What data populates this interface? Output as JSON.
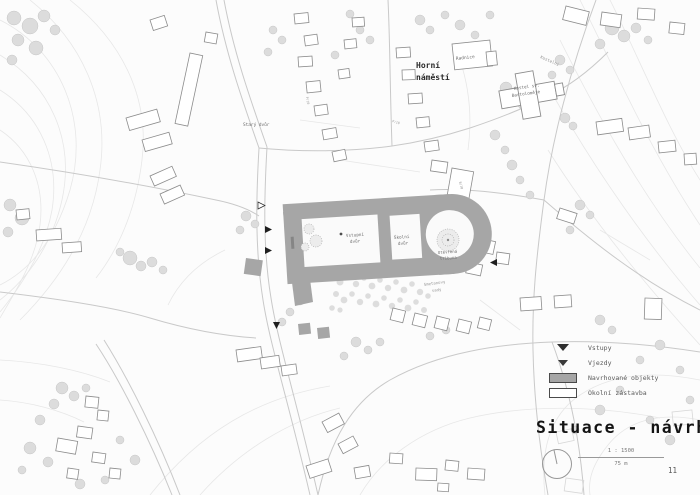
{
  "document": {
    "type": "architectural-site-plan",
    "page_number": "11"
  },
  "title_block": {
    "title": "Situace - návrh",
    "scale_ratio": "1 : 1500",
    "scale_length": "75 m"
  },
  "legend": {
    "items": [
      {
        "id": "vstupy",
        "marker": "triangle-solid",
        "label": "Vstupy"
      },
      {
        "id": "vjezdy",
        "marker": "triangle-small",
        "label": "Vjezdy"
      },
      {
        "id": "navrhovane-objekty",
        "marker": "rect-gray",
        "label": "Navrhované objekty"
      },
      {
        "id": "okolni-zastavba",
        "marker": "rect-white",
        "label": "Okolní zástavba"
      }
    ]
  },
  "map_labels": {
    "square_l1": "Horní",
    "square_l2": "náměstí",
    "townhall": "Radnice",
    "church_l1": "Kostel sv.",
    "church_l2": "Bartoloměje",
    "street_kostelni": "Kostelní",
    "old_yard": "Starý dvůr",
    "entry_court_l1": "Vstupní",
    "entry_court_l2": "dvůr",
    "school_court_l1": "Školní",
    "school_court_l2": "dvůr",
    "tribune_l1": "Otevřená",
    "tribune_l2": "tribuna",
    "park_l1": "Smetanovy",
    "park_l2": "sady",
    "marks": [
      "P/10",
      "B/10",
      "P/10"
    ]
  },
  "colors": {
    "paper": "#fcfcfc",
    "ink": "#141414",
    "proposed_fill": "#a6a6a6",
    "building_stroke": "#8c8c8c",
    "tree_fill": "#dddddd",
    "contour": "#e7e7e7",
    "road": "#c9c9c9",
    "label_gray": "#6e6e6e"
  }
}
